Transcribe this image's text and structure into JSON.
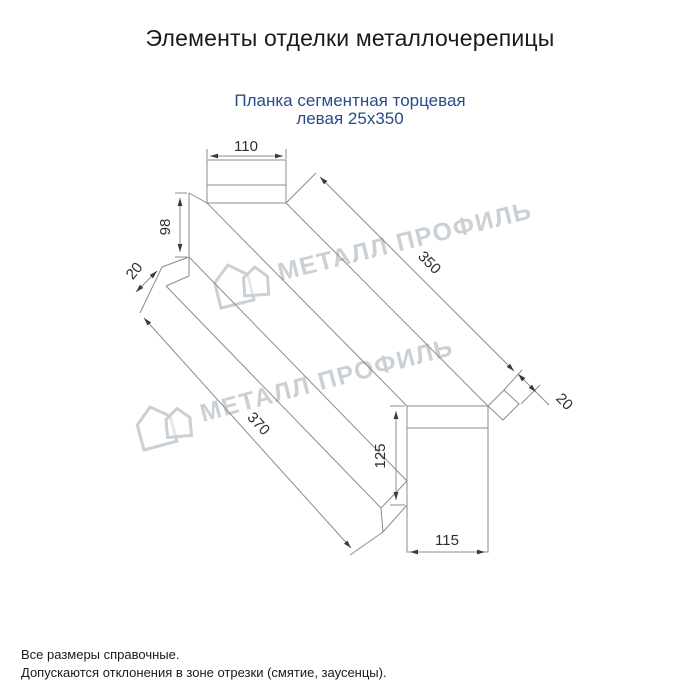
{
  "page": {
    "title": "Элементы отделки металлочерепицы",
    "subtitle_line1": "Планка сегментная торцевая",
    "subtitle_line2": "левая 25x350"
  },
  "drawing": {
    "dimensions": {
      "top_width": "110",
      "left_height": "98",
      "left_flange": "20",
      "segment_length": "350",
      "right_flange": "20",
      "total_length": "370",
      "end_height": "125",
      "end_width": "115"
    }
  },
  "watermark": {
    "text": "МЕТАЛЛ ПРОФИЛЬ"
  },
  "notes": {
    "line1": "Все размеры справочные.",
    "line2": "Допускаются отклонения в зоне отрезки (смятие, заусенцы)."
  },
  "colors": {
    "subtitle": "#2a4a8a",
    "line": "#8c8c8c",
    "dim_text": "#2e2e2e",
    "watermark": "#c2c8cd",
    "text": "#1a1a1a"
  }
}
